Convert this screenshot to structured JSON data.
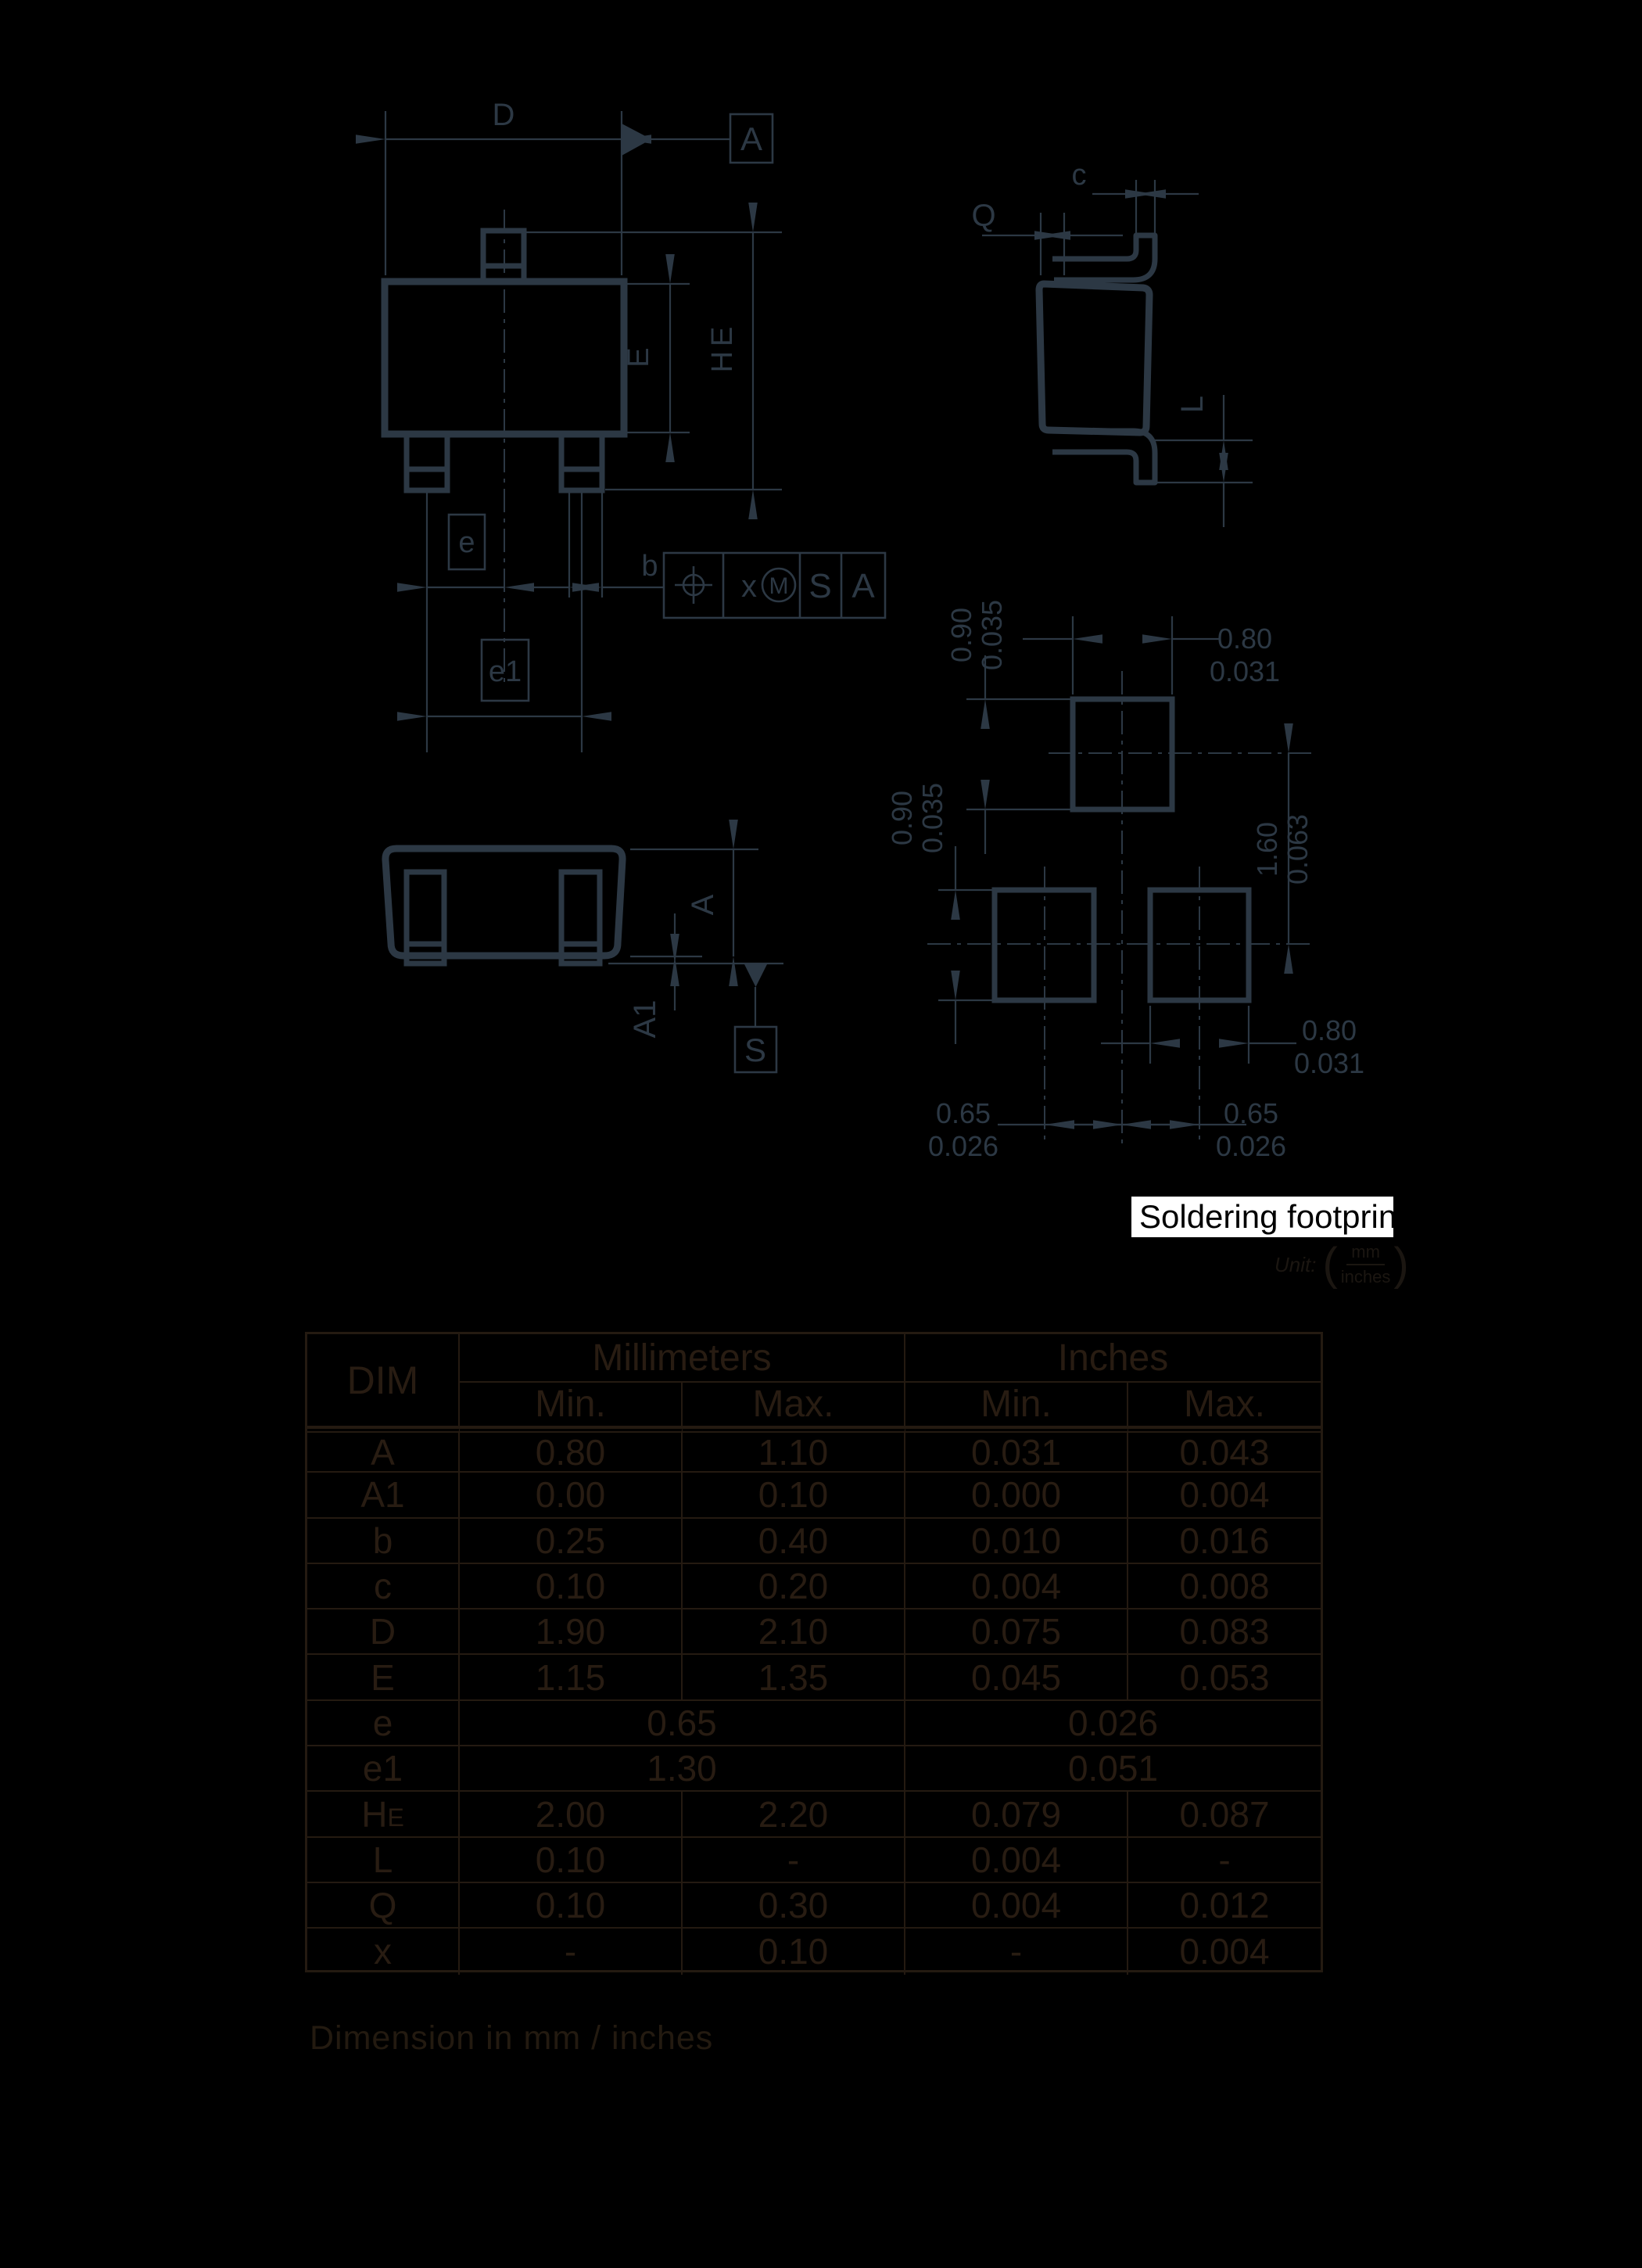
{
  "colors": {
    "background": "#000000",
    "drawing_ink": "#2c3844",
    "table_ink": "#261b12",
    "highlight_bg": "#ffffff",
    "highlight_text": "#000000"
  },
  "drawing": {
    "top_view": {
      "d_label": "D",
      "datum_a_flag": "A",
      "e_label": "E",
      "he_label": "HE",
      "pitch_e_label": "e",
      "pitch_e1_label": "e1",
      "b_label": "b",
      "fcf": {
        "x": "x",
        "m": "M",
        "s": "S",
        "a": "A"
      }
    },
    "side_view": {
      "c_label": "c",
      "q_label": "Q",
      "l_label": "L"
    },
    "front_view": {
      "a_label": "A",
      "a1_label": "A1",
      "datum_s_label": "S"
    }
  },
  "footprint": {
    "caption": "Soldering footprint",
    "dims": {
      "pad_top_h_mm": "0.90",
      "pad_top_h_in": "0.035",
      "pad_top_w_mm": "0.80",
      "pad_top_w_in": "0.031",
      "pad_bot_h_mm": "0.90",
      "pad_bot_h_in": "0.035",
      "pitch_v_mm": "1.60",
      "pitch_v_in": "0.063",
      "pad_bot_w_mm": "0.80",
      "pad_bot_w_in": "0.031",
      "pitch_left_mm": "0.65",
      "pitch_left_in": "0.026",
      "pitch_right_mm": "0.65",
      "pitch_right_in": "0.026"
    }
  },
  "unit_note": {
    "prefix": "Unit:",
    "numerator": "mm",
    "denominator": "inches"
  },
  "table": {
    "col_dim": "DIM",
    "col_mm": "Millimeters",
    "col_in": "Inches",
    "col_min_mm": "Min.",
    "col_max_mm": "Max.",
    "col_min_in": "Min.",
    "col_max_in": "Max.",
    "rows": [
      {
        "dim": "A",
        "sub": "",
        "merged": false,
        "mm_min": "0.80",
        "mm_max": "1.10",
        "in_min": "0.031",
        "in_max": "0.043"
      },
      {
        "dim": "A1",
        "sub": "",
        "merged": false,
        "mm_min": "0.00",
        "mm_max": "0.10",
        "in_min": "0.000",
        "in_max": "0.004"
      },
      {
        "dim": "b",
        "sub": "",
        "merged": false,
        "mm_min": "0.25",
        "mm_max": "0.40",
        "in_min": "0.010",
        "in_max": "0.016"
      },
      {
        "dim": "c",
        "sub": "",
        "merged": false,
        "mm_min": "0.10",
        "mm_max": "0.20",
        "in_min": "0.004",
        "in_max": "0.008"
      },
      {
        "dim": "D",
        "sub": "",
        "merged": false,
        "mm_min": "1.90",
        "mm_max": "2.10",
        "in_min": "0.075",
        "in_max": "0.083"
      },
      {
        "dim": "E",
        "sub": "",
        "merged": false,
        "mm_min": "1.15",
        "mm_max": "1.35",
        "in_min": "0.045",
        "in_max": "0.053"
      },
      {
        "dim": "e",
        "sub": "",
        "merged": true,
        "mm": "0.65",
        "inch": "0.026"
      },
      {
        "dim": "e1",
        "sub": "",
        "merged": true,
        "mm": "1.30",
        "inch": "0.051"
      },
      {
        "dim": "H",
        "sub": "E",
        "merged": false,
        "mm_min": "2.00",
        "mm_max": "2.20",
        "in_min": "0.079",
        "in_max": "0.087"
      },
      {
        "dim": "L",
        "sub": "",
        "merged": false,
        "mm_min": "0.10",
        "mm_max": "-",
        "in_min": "0.004",
        "in_max": "-"
      },
      {
        "dim": "Q",
        "sub": "",
        "merged": false,
        "mm_min": "0.10",
        "mm_max": "0.30",
        "in_min": "0.004",
        "in_max": "0.012"
      },
      {
        "dim": "x",
        "sub": "",
        "merged": false,
        "mm_min": "-",
        "mm_max": "0.10",
        "in_min": "-",
        "in_max": "0.004"
      }
    ]
  },
  "bottom_note": "Dimension in mm / inches"
}
